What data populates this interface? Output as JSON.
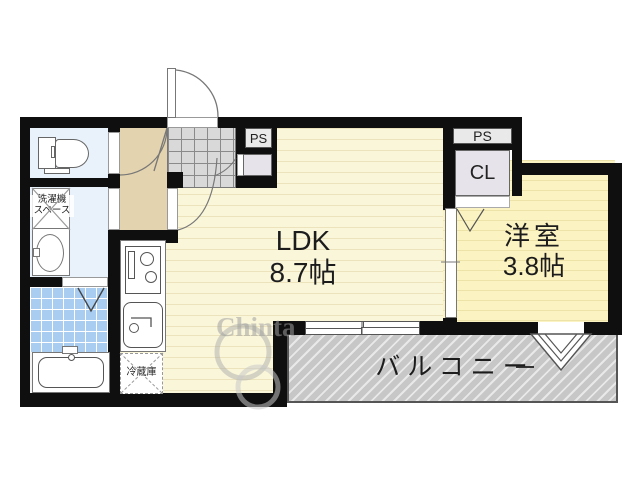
{
  "floorplan": {
    "type": "japanese-apartment-1ldk",
    "rooms": {
      "ldk": {
        "name": "LDK",
        "size": "8.7帖"
      },
      "bedroom": {
        "name": "洋室",
        "size": "3.8帖"
      },
      "balcony": {
        "name": "バルコニー"
      },
      "closet": {
        "label": "CL"
      },
      "pipe_space_entrance": {
        "label": "PS"
      },
      "pipe_space_bedroom": {
        "label": "PS"
      },
      "washer_space": {
        "line1": "洗濯機",
        "line2": "スペース"
      },
      "fridge_space": {
        "label": "冷蔵庫"
      }
    },
    "fixtures": [
      "toilet-icon",
      "washbasin-icon",
      "bathtub-icon",
      "kitchen-stove-icon",
      "kitchen-sink-icon",
      "entrance-door-arc",
      "balcony-window-chevron"
    ],
    "watermark": {
      "text": "Chinta"
    },
    "colors": {
      "wall": "#0f0f0f",
      "ldk_floor": "#faf6da",
      "bedroom_floor": "#fbf3c2",
      "hall_floor": "#e3d3ae",
      "genkan_tile": "#d9d9d9",
      "wet_room_floor": "#e9f1fa",
      "bath_tile": "#a9cdf0",
      "balcony": "#c7c7c7",
      "closet_floor": "#e6e3eb",
      "pipe_space": "#e9e9e9"
    }
  }
}
